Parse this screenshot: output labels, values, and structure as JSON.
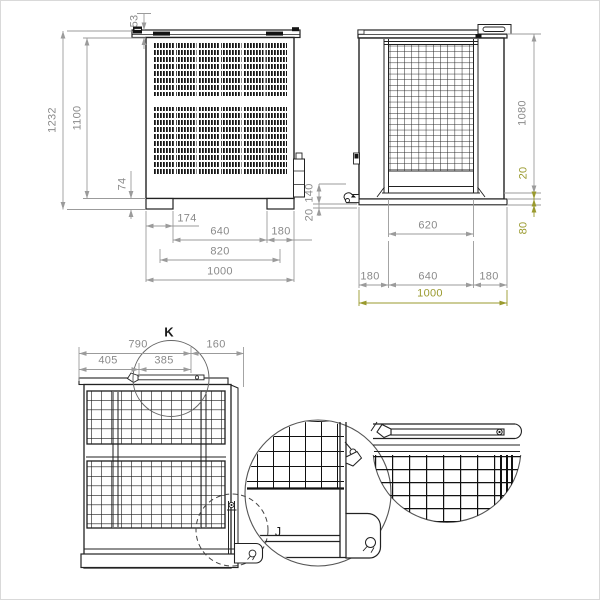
{
  "drawing": {
    "colors": {
      "line": "#222222",
      "dim": "#8a8a8a",
      "accent_olive": "#9a9a2e"
    },
    "front_view": {
      "height_total": "1232",
      "height_body": "1100",
      "lid_offset": "53",
      "foot_height": "74",
      "left_foot_offset": "174",
      "between_feet": "640",
      "right_offset": "180",
      "feet_span": "820",
      "width_total": "1000"
    },
    "side_view": {
      "hook_height": "140",
      "hook_offset": "20",
      "height_body": "1080",
      "sill_gap": "20",
      "base_height": "80",
      "door_width": "620",
      "left_offset": "180",
      "center_span": "640",
      "right_offset": "180",
      "width_total": "1000"
    },
    "perspective_view": {
      "rail_span": "790",
      "rail_right_offset": "160",
      "latch_left_offset": "405",
      "latch_span": "385",
      "detail_k_label": "K",
      "detail_j_label": "J"
    }
  }
}
